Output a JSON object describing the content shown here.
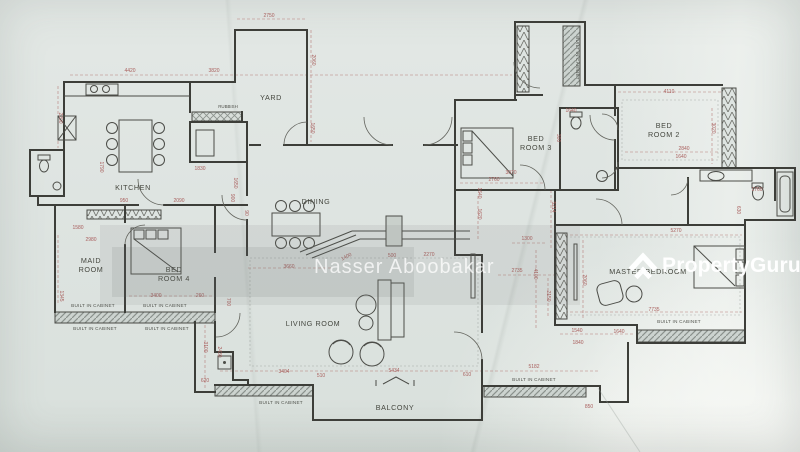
{
  "watermark": {
    "agent": "Nasser Aboobakar",
    "brand_property": "Property",
    "brand_guru": "Guru"
  },
  "rooms": [
    {
      "lines": [
        "YARD"
      ],
      "x": 271,
      "y": 100
    },
    {
      "lines": [
        "KITCHEN"
      ],
      "x": 133,
      "y": 190
    },
    {
      "lines": [
        "DINING"
      ],
      "x": 316,
      "y": 204
    },
    {
      "lines": [
        "BED",
        "ROOM 3"
      ],
      "x": 536,
      "y": 141,
      "lh": 9
    },
    {
      "lines": [
        "BED",
        "ROOM 2"
      ],
      "x": 664,
      "y": 128,
      "lh": 9
    },
    {
      "lines": [
        "MAID",
        "ROOM"
      ],
      "x": 91,
      "y": 263,
      "lh": 9
    },
    {
      "lines": [
        "BED",
        "ROOM 4"
      ],
      "x": 174,
      "y": 272,
      "lh": 9
    },
    {
      "lines": [
        "LIVING ROOM"
      ],
      "x": 313,
      "y": 326
    },
    {
      "lines": [
        "MASTER BEDROOM"
      ],
      "x": 648,
      "y": 274
    },
    {
      "lines": [
        "BALCONY"
      ],
      "x": 395,
      "y": 410
    }
  ],
  "cabinet_labels": [
    {
      "label": "BUILT IN CABINET",
      "x": 576,
      "y": 58,
      "rot": 90
    },
    {
      "label": "BUILT IN CABINET",
      "x": 93,
      "y": 307
    },
    {
      "label": "BUILT IN CABINET",
      "x": 165,
      "y": 307
    },
    {
      "label": "BUILT IN CABINET",
      "x": 95,
      "y": 330
    },
    {
      "label": "BUILT IN CABINET",
      "x": 167,
      "y": 330
    },
    {
      "label": "BUILT IN CABINET",
      "x": 281,
      "y": 404
    },
    {
      "label": "BUILT IN CABINET",
      "x": 534,
      "y": 381
    },
    {
      "label": "BUILT IN CABINET",
      "x": 679,
      "y": 323
    }
  ],
  "fixture_labels": [
    {
      "label": "RUBBISH",
      "x": 228,
      "y": 108
    }
  ],
  "dimensions": [
    {
      "t": "2750",
      "x": 269,
      "y": 17
    },
    {
      "t": "2060",
      "x": 312,
      "y": 60,
      "rot": 90
    },
    {
      "t": "4420",
      "x": 130,
      "y": 72
    },
    {
      "t": "3820",
      "x": 214,
      "y": 72
    },
    {
      "t": "2200",
      "x": 59,
      "y": 118,
      "rot": 90
    },
    {
      "t": "1650",
      "x": 311,
      "y": 128,
      "rot": 90
    },
    {
      "t": "1830",
      "x": 200,
      "y": 170
    },
    {
      "t": "1650",
      "x": 234,
      "y": 183,
      "rot": 90
    },
    {
      "t": "1790",
      "x": 100,
      "y": 167,
      "rot": 90
    },
    {
      "t": "1580",
      "x": 78,
      "y": 229
    },
    {
      "t": "2980",
      "x": 91,
      "y": 241
    },
    {
      "t": "950",
      "x": 124,
      "y": 202
    },
    {
      "t": "2090",
      "x": 179,
      "y": 202
    },
    {
      "t": "900",
      "x": 231,
      "y": 198,
      "rot": 90
    },
    {
      "t": "90",
      "x": 245,
      "y": 213,
      "rot": 90
    },
    {
      "t": "1345",
      "x": 60,
      "y": 296,
      "rot": 90
    },
    {
      "t": "3400",
      "x": 156,
      "y": 297
    },
    {
      "t": "260",
      "x": 200,
      "y": 297
    },
    {
      "t": "700",
      "x": 227,
      "y": 302,
      "rot": 90
    },
    {
      "t": "3100",
      "x": 204,
      "y": 347,
      "rot": 90
    },
    {
      "t": "2430",
      "x": 218,
      "y": 352,
      "rot": 90
    },
    {
      "t": "620",
      "x": 205,
      "y": 382
    },
    {
      "t": "3404",
      "x": 284,
      "y": 373
    },
    {
      "t": "510",
      "x": 321,
      "y": 377
    },
    {
      "t": "5434",
      "x": 394,
      "y": 372
    },
    {
      "t": "610",
      "x": 467,
      "y": 376
    },
    {
      "t": "5182",
      "x": 534,
      "y": 368
    },
    {
      "t": "850",
      "x": 589,
      "y": 408
    },
    {
      "t": "3660",
      "x": 289,
      "y": 268
    },
    {
      "t": "1400",
      "x": 347,
      "y": 258,
      "rot": -28
    },
    {
      "t": "500",
      "x": 392,
      "y": 257
    },
    {
      "t": "2270",
      "x": 429,
      "y": 256
    },
    {
      "t": "1620",
      "x": 478,
      "y": 214,
      "rot": 90
    },
    {
      "t": "5214",
      "x": 552,
      "y": 207,
      "rot": 90
    },
    {
      "t": "1640",
      "x": 478,
      "y": 193,
      "rot": 90
    },
    {
      "t": "1300",
      "x": 527,
      "y": 240
    },
    {
      "t": "2735",
      "x": 517,
      "y": 272
    },
    {
      "t": "4100",
      "x": 534,
      "y": 274,
      "rot": 90
    },
    {
      "t": "2150",
      "x": 547,
      "y": 296,
      "rot": 90
    },
    {
      "t": "2060",
      "x": 583,
      "y": 280,
      "rot": 90
    },
    {
      "t": "2760",
      "x": 494,
      "y": 181
    },
    {
      "t": "3070",
      "x": 511,
      "y": 174
    },
    {
      "t": "1640",
      "x": 571,
      "y": 112
    },
    {
      "t": "300",
      "x": 557,
      "y": 138,
      "rot": 90
    },
    {
      "t": "4110",
      "x": 669,
      "y": 93
    },
    {
      "t": "3020",
      "x": 712,
      "y": 128,
      "rot": 90
    },
    {
      "t": "2840",
      "x": 684,
      "y": 150
    },
    {
      "t": "1640",
      "x": 681,
      "y": 158
    },
    {
      "t": "1760",
      "x": 757,
      "y": 191
    },
    {
      "t": "630",
      "x": 737,
      "y": 210,
      "rot": 90
    },
    {
      "t": "5270",
      "x": 676,
      "y": 232
    },
    {
      "t": "7735",
      "x": 654,
      "y": 311
    },
    {
      "t": "1640",
      "x": 619,
      "y": 333
    },
    {
      "t": "1540",
      "x": 577,
      "y": 332
    },
    {
      "t": "1840",
      "x": 578,
      "y": 344
    }
  ],
  "colors": {
    "paper": "#dee4e1",
    "wall": "#3d3e39",
    "dimension_text": "#a95f5d",
    "label_text": "#45473f",
    "cabinet_fill": "#ccd3cf",
    "watermark_text": "#ffffff",
    "brand_text": "#ffffff"
  }
}
